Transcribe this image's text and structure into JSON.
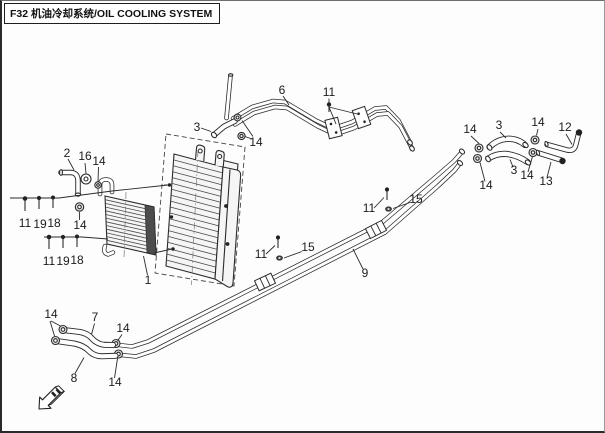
{
  "header": {
    "title": "F32 机油冷却系统/OIL COOLING SYSTEM"
  },
  "diagram": {
    "description": "Exploded parts diagram of the oil cooling system: oil cooler core, oil pipes and hoses with fasteners, radiator shown as dashed reference",
    "icons": {
      "direction_arrow": "front-direction-arrow"
    },
    "callouts": [
      {
        "label": "2"
      },
      {
        "label": "16"
      },
      {
        "label": "14"
      },
      {
        "label": "11"
      },
      {
        "label": "19"
      },
      {
        "label": "18"
      },
      {
        "label": "14"
      },
      {
        "label": "11"
      },
      {
        "label": "19"
      },
      {
        "label": "18"
      },
      {
        "label": "1"
      },
      {
        "label": "3"
      },
      {
        "label": "14"
      },
      {
        "label": "6"
      },
      {
        "label": "11"
      },
      {
        "label": "11"
      },
      {
        "label": "15"
      },
      {
        "label": "9"
      },
      {
        "label": "11"
      },
      {
        "label": "15"
      },
      {
        "label": "14"
      },
      {
        "label": "3"
      },
      {
        "label": "14"
      },
      {
        "label": "12"
      },
      {
        "label": "14"
      },
      {
        "label": "3"
      },
      {
        "label": "14"
      },
      {
        "label": "13"
      },
      {
        "label": "14"
      },
      {
        "label": "7"
      },
      {
        "label": "14"
      },
      {
        "label": "8"
      },
      {
        "label": "14"
      }
    ]
  }
}
